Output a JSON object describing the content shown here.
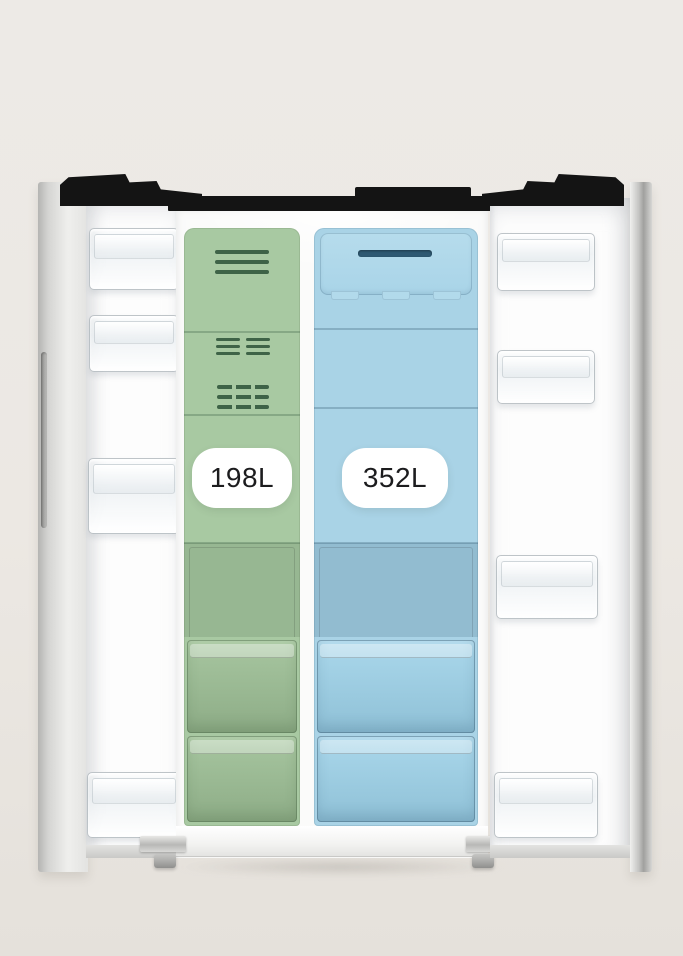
{
  "scene": {
    "background_color": "#ECE8E3",
    "subject": "side-by-side refrigerator with both doors open, interior compartments highlighted"
  },
  "compartments": {
    "freezer": {
      "capacity_label": "198L",
      "highlight_color": "#A8C9A2",
      "vent_color": "#3E6347"
    },
    "fridge": {
      "capacity_label": "352L",
      "highlight_color": "#A9D3E6",
      "vent_color": "#2E5972"
    }
  },
  "trim": {
    "top_panel_color": "#141414",
    "badge_background": "#FFFFFF",
    "badge_text_color": "#1C1C1E"
  }
}
